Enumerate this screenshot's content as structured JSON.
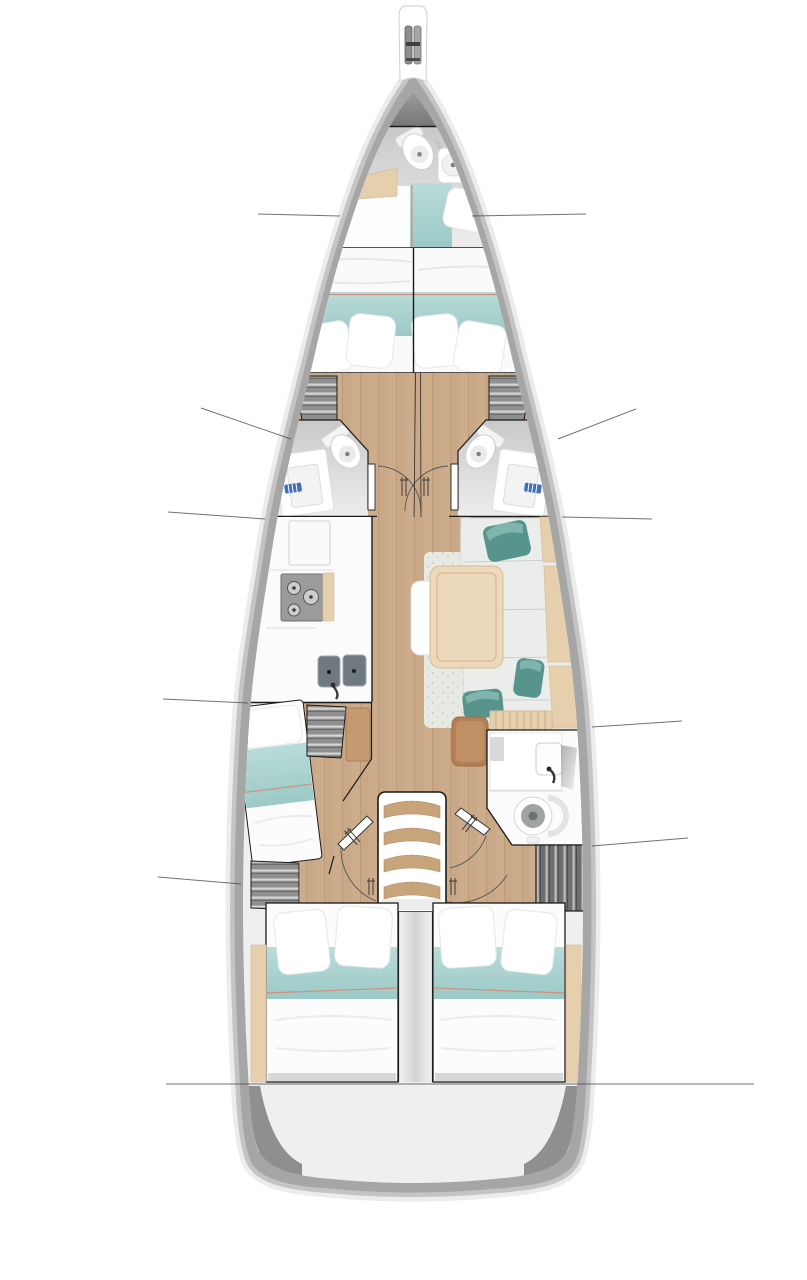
{
  "diagram": {
    "type": "yacht-interior-floor-plan",
    "view": "top-down deck plan of a sailing monohull",
    "orientation": "bow at top, stern at bottom"
  },
  "colors": {
    "band": "#a6a6a6",
    "rim": "#dcdcdc",
    "interior": "#efeff0",
    "deckdark": "#858585",
    "wood": "#c8a886",
    "woodlight": "#e6cfad",
    "table": "#ecd8ba",
    "teal": "#a9d3d0",
    "tealdark": "#57948c",
    "tealhi": "#7fb5ad",
    "piping": "#cf8f7e",
    "sofa": "#ebedea",
    "rug": "#e7eae2",
    "shelf": "#8f8f8f",
    "shelfdark": "#6e6e6e",
    "stove": "#9b9b9b",
    "sink": "#6f7a80",
    "brown": "#b57f55",
    "line": "#444444",
    "outline": "#1a1a1a",
    "fixture": "#fbfbfb"
  },
  "areas": [
    {
      "id": "bowsprit",
      "name": "Bowsprit with anchor roller"
    },
    {
      "id": "forepeak",
      "name": "Forepeak anchor locker"
    },
    {
      "id": "bow-cabin",
      "name": "Bow cabin with toilet, sink and single berth"
    },
    {
      "id": "v-berth",
      "name": "Forward owner V-berth, split double"
    },
    {
      "id": "head-fwd-port",
      "name": "Port forward head with toilet and vanity"
    },
    {
      "id": "head-fwd-stbd",
      "name": "Starboard forward head with toilet and vanity"
    },
    {
      "id": "mast-step",
      "name": "Mast step"
    },
    {
      "id": "galley",
      "name": "Port galley: cabinets, 3-burner stove, double sink"
    },
    {
      "id": "salon",
      "name": "Starboard salon: dining table, L-sofa, bench, rug, 3 teal pillows"
    },
    {
      "id": "cabin-midship-port",
      "name": "Port midship cabin with single berth and shelves"
    },
    {
      "id": "nav-seat",
      "name": "Navigation seat"
    },
    {
      "id": "head-aft-stbd",
      "name": "Starboard aft head with sink, shower and toilet"
    },
    {
      "id": "companionway",
      "name": "Companionway stairs, 4 treads"
    },
    {
      "id": "engine-column",
      "name": "Engine compartment column between aft cabins"
    },
    {
      "id": "cabin-aft-port",
      "name": "Port aft double cabin"
    },
    {
      "id": "cabin-aft-stbd",
      "name": "Starboard aft double cabin"
    },
    {
      "id": "transom",
      "name": "Stern transom platform"
    }
  ],
  "callout_lines": [
    {
      "x1": 258,
      "y1": 214,
      "x2": 340,
      "y2": 216
    },
    {
      "x1": 472,
      "y1": 216,
      "x2": 586,
      "y2": 214
    },
    {
      "x1": 201,
      "y1": 408,
      "x2": 291,
      "y2": 439
    },
    {
      "x1": 558,
      "y1": 439,
      "x2": 636,
      "y2": 409
    },
    {
      "x1": 168,
      "y1": 512,
      "x2": 265,
      "y2": 519
    },
    {
      "x1": 562,
      "y1": 517,
      "x2": 652,
      "y2": 519
    },
    {
      "x1": 163,
      "y1": 699,
      "x2": 248,
      "y2": 703
    },
    {
      "x1": 592,
      "y1": 727,
      "x2": 682,
      "y2": 721
    },
    {
      "x1": 158,
      "y1": 877,
      "x2": 241,
      "y2": 884
    },
    {
      "x1": 592,
      "y1": 846,
      "x2": 688,
      "y2": 838
    },
    {
      "x1": 166,
      "y1": 1084,
      "x2": 754,
      "y2": 1084
    }
  ]
}
